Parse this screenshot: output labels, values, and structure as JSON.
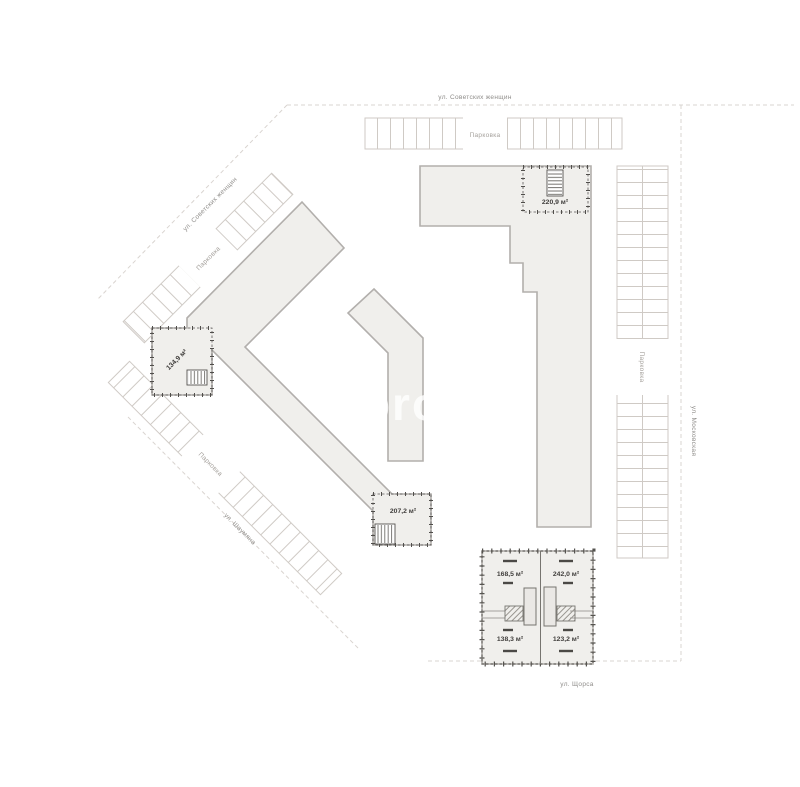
{
  "streets": {
    "top": {
      "name": "ул. Советских женщин"
    },
    "top_left": {
      "name": "ул. Советских женщин"
    },
    "right": {
      "name": "ул. Московская"
    },
    "bottom": {
      "name": "ул. Щорса"
    },
    "bottom_left": {
      "name": "ул. Шаумяна"
    }
  },
  "parking": {
    "label": "Парковка"
  },
  "units": {
    "top_right": {
      "area": "220,9 м²"
    },
    "left": {
      "area": "134,9 м²"
    },
    "lower": {
      "area": "207,2 м²"
    },
    "q_tl": {
      "area": "168,5 м²"
    },
    "q_tr": {
      "area": "242,0 м²"
    },
    "q_bl": {
      "area": "138,3 м²"
    },
    "q_br": {
      "area": "123,2 м²"
    }
  },
  "watermark": {
    "text": "pro"
  },
  "colors": {
    "background": "#ffffff",
    "building_fill": "#f0efec",
    "building_stroke": "#b2afac",
    "unit_border": "#504e4b",
    "street_line": "#d9d4d0",
    "street_label": "#8f8d8a",
    "parking_line": "#cfcac5",
    "parking_label": "#a5a19c",
    "area_label": "#403e3c"
  }
}
